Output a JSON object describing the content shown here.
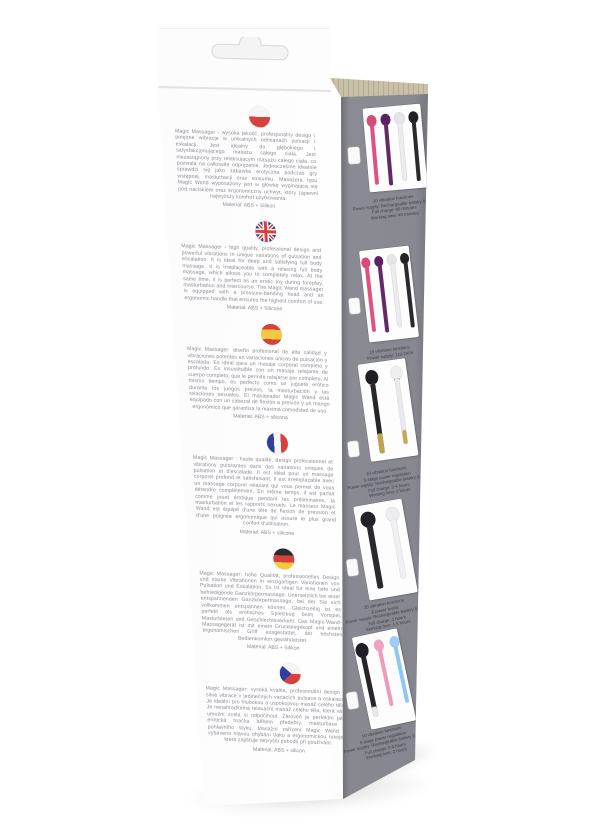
{
  "photo_subject": "Magic Massager retail packaging box, angled product photo",
  "colors": {
    "cardboard": "#c9c0a8",
    "panel_gray": "#8c8c95",
    "flag_red": "#d84040",
    "flag_blue": "#2c3f9e",
    "flag_yellow": "#f3c93e"
  },
  "front_panel": {
    "sections": [
      {
        "flag": "poland",
        "text": "Magic Massager - wysoka jakość, profesjonalny design i potężne wibracje w unikalnych odmianach pulsacji i eskalacji. Jest idealny do głębokiego i satysfakcjonującego masażu całego ciała. Jest niezastąpiony przy relaksującym masażu całego ciała, co pozwala na całkowite odprężenie. Jednocześnie idealnie sprawdzi się jako zabawka erotyczna podczas gry wstępnej, masturbacji oraz stosunku. Masażera typu Magic Wand wyposażony jest w główkę wyginającą się pod naciskiem oraz ergonomiczny uchwyt, który zapewni najwyższy komfort użytkowania.",
        "material": "Material: ABS + Silikon"
      },
      {
        "flag": "united-kingdom",
        "text": "Magic Massager - high quality, professional design and powerful vibrations in unique variations of pulsation and escalation. It is ideal for deep and satisfying full body massage. It is irreplaceable with a relaxing full body massage, which allows you to completely relax. At the same time, it is perfect as an erotic toy during foreplay, masturbation and intercourse. The Magic Wand massager is equipped with a pressure-bending head and an ergonomic handle that ensures the highest comfort of use.",
        "material": "Material: ABS + Silicone"
      },
      {
        "flag": "spain",
        "text": "Magic Massager: diseño profesional de alta calidad y vibraciones potentes en variaciones únicas de pulsación y escalada. Es ideal para un masaje corporal completo y profundo. Es insustituible con un masaje relajante de cuerpo completo, que le permite relajarse por completo. Al mismo tiempo, es perfecto como un juguete erótico durante los juegos previos, la masturbación y las relaciones sexuales. El masajeador Magic Wand está equipado con un cabezal de flexión a presión y un mango ergonómico que garantiza la máxima comodidad de uso.",
        "material": "Material: ABS + silicona"
      },
      {
        "flag": "france",
        "text": "Magic Massager : haute qualité, design professionnel et vibrations puissantes dans des variations uniques de pulsation et d'escalade. Il est idéal pour un massage corporel profond et satisfaisant. Il est irremplaçable avec un massage corporel relaxant qui vous permet de vous détendre complètement. En même temps, il est parfait comme jouet érotique pendant les préliminaires, la masturbation et les rapports sexuels. Le masseur Magic Wand est équipé d'une tête de flexion de pression et d'une poignée ergonomique qui assure le plus grand confort d'utilisation.",
        "material": "Materiel: ABS + silicone"
      },
      {
        "flag": "germany",
        "text": "Magic Massager: hohe Qualität, professionelles Design und starke Vibrationen in einzigartigen Variationen von Pulsation und Eskalation. Es ist ideal für eine tiefe und befriedigende Ganzkörpermassage. Unersetzlich bei einer entspannenden Ganzkörpermassage, bei der Sie sich vollkommen entspannen können. Gleichzeitig ist es perfekt als erotisches Spielzeug beim Vorspiel, Masturbieren und Geschlechtsverkehr. Das Magic-Wand-Massagegerät ist mit einem Druckbiegekopf und einem ergonomischen Griff ausgestattet, der höchsten Bedienkomfort gewährleistet.",
        "material": "Material: ABS + Silikon"
      },
      {
        "flag": "czech-republic",
        "text": "Magic Massager: vysoká kvalita, profesionální design a silné vibrace v jedinečných variacích pulsace a eskalace. Je ideální pro hlubokou a uspokojivou masáž celého těla. Je nenahraditelná relaxační masáž celého těla, která vám umožní zcela si odpočinout. Zároveň je perfektní jako erotická hračka během předehry, masturbace a pohlavního styku. Masážní zařízení Magic Wand je vybaveno hlavou ohýbání tlaku a ergonomickou rukojetí, která zajišťuje nejvyšší pohodlí při používání.",
        "material": "Material: ABS + silicon"
      }
    ]
  },
  "side_panel": {
    "blocks": [
      {
        "specs": [
          "10 vibration functions",
          "Power supply: Rechargeable battery (USB)",
          "Full charge: 90 minutes",
          "Working time: 40 minutes"
        ],
        "wands": [
          {
            "name": "pink wand",
            "head": "#d94a78",
            "body": "#e0517f"
          },
          {
            "name": "purple wand",
            "head": "#5a2260",
            "body": "#632a68"
          },
          {
            "name": "white wand",
            "head": "#e6e6e9",
            "body": "#ececef"
          },
          {
            "name": "black wand",
            "head": "#222226",
            "body": "#2a2a2e"
          }
        ]
      },
      {
        "specs": [
          "10 vibration functions",
          "Power supply: 110-240V"
        ],
        "wands": [
          {
            "name": "pink wand",
            "head": "#d94a78",
            "body": "#e0517f"
          },
          {
            "name": "purple wand",
            "head": "#5a2260",
            "body": "#632a68"
          },
          {
            "name": "white wand",
            "head": "#e6e6e9",
            "body": "#ececef"
          },
          {
            "name": "black wand",
            "head": "#222226",
            "body": "#2a2a2e"
          }
        ]
      },
      {
        "specs": [
          "10 vibration functions",
          "5-stage power regulation",
          "Power supply: Rechargeable battery (USB)",
          "Full charge: 2-4 hours",
          "Working time: 2 hours"
        ],
        "wands": [
          {
            "name": "black-gold wand",
            "head": "#1f1f23",
            "body": "#26262a",
            "ring": "#d98c80",
            "accent": "#bfa14e"
          },
          {
            "name": "white-gold wand",
            "head": "#efeff1",
            "body": "#e9e9ec",
            "ring": "#d98c80",
            "accent": "#c6a854"
          }
        ]
      },
      {
        "specs": [
          "20 vibration functions",
          "8 power levels",
          "Power supply: Rechargeable battery (USB)",
          "Full charge: 2 hours",
          "Working time: 1.5 hours"
        ],
        "wands": [
          {
            "name": "black wand",
            "head": "#222226",
            "body": "#2a2a2e"
          },
          {
            "name": "white wand",
            "head": "#ededf0",
            "body": "#f0f0f2"
          }
        ]
      },
      {
        "specs": [
          "10 vibration functions",
          "5-stage power regulation",
          "Power supply: Rechargeable battery (USB)",
          "Full charge: 2-4 hours",
          "Working time: 2 hours"
        ],
        "wands": [
          {
            "name": "black wand",
            "head": "#1f1f23",
            "body": "#26262a",
            "accent": "#e8e8ea"
          },
          {
            "name": "pink wand",
            "head": "#f0a3c0",
            "body": "#ee9abb"
          },
          {
            "name": "blue wand",
            "head": "#9ccdf2",
            "body": "#90c6f0"
          }
        ]
      }
    ]
  }
}
